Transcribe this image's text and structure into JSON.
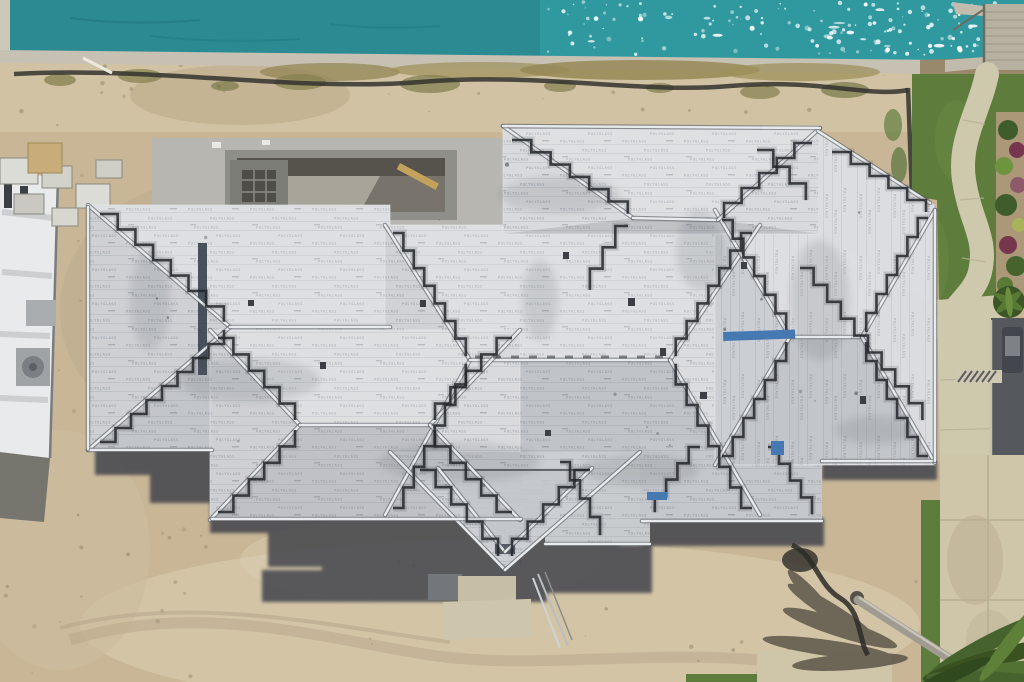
{
  "meta": {
    "description": "Aerial drone photo of a large waterfront home under construction: complex hip roof covered in white printed underlayment, sandy lot, teal canal with dock at top, pool shell, neighboring white house at left, lawn with curved path, driveway and palm tree at right",
    "brand_print": "POLYGLASS"
  },
  "palette": {
    "water": "#2B8A92",
    "waterSpark": "#319AA2",
    "sparkle": "#FFFFFF",
    "seawall": "#C6C1B2",
    "sand": "#C8B697",
    "sandLight": "#D9CCAE",
    "roof": "#D8DADD",
    "roofShade": "#767D85",
    "metal": "#ECF0F3",
    "metalDark": "#5D6166",
    "tar": "#23262A",
    "slate": "#39414E",
    "shadow": "#3D4148",
    "grass": "#5E7C3C",
    "path": "#CEC8AC",
    "pavement": "#CFC5A8",
    "asphalt": "#55585D",
    "mulch": "#AB9878",
    "plantGreen": "#3F5C2C",
    "plantPurple": "#76374E",
    "poolDeck": "#B7B6B0",
    "poolShadow": "#56534C",
    "building": "#E9EAEB",
    "palm": "#46632D",
    "trunk": "#A09B90",
    "tarp": "#4679B2",
    "wood": "#C2A25C"
  },
  "scene": {
    "objects": [
      "water-channel",
      "sun-glints",
      "boat-dock",
      "seawall",
      "silt-fence",
      "construction-sand-lot",
      "swimming-pool-shell",
      "spa-form",
      "neighboring-house",
      "material-pallets",
      "ac-equipment",
      "hip-roof-underlayment",
      "metal-ridge-flashing",
      "tar-stepped-valleys",
      "blue-tarps",
      "roof-vents",
      "ground-shadow",
      "concrete-steps",
      "lawn",
      "garden-path",
      "planting-bed",
      "asphalt-pad",
      "concrete-driveway",
      "palm-tree",
      "palm-shadow",
      "fallen-palm-trunk"
    ]
  }
}
